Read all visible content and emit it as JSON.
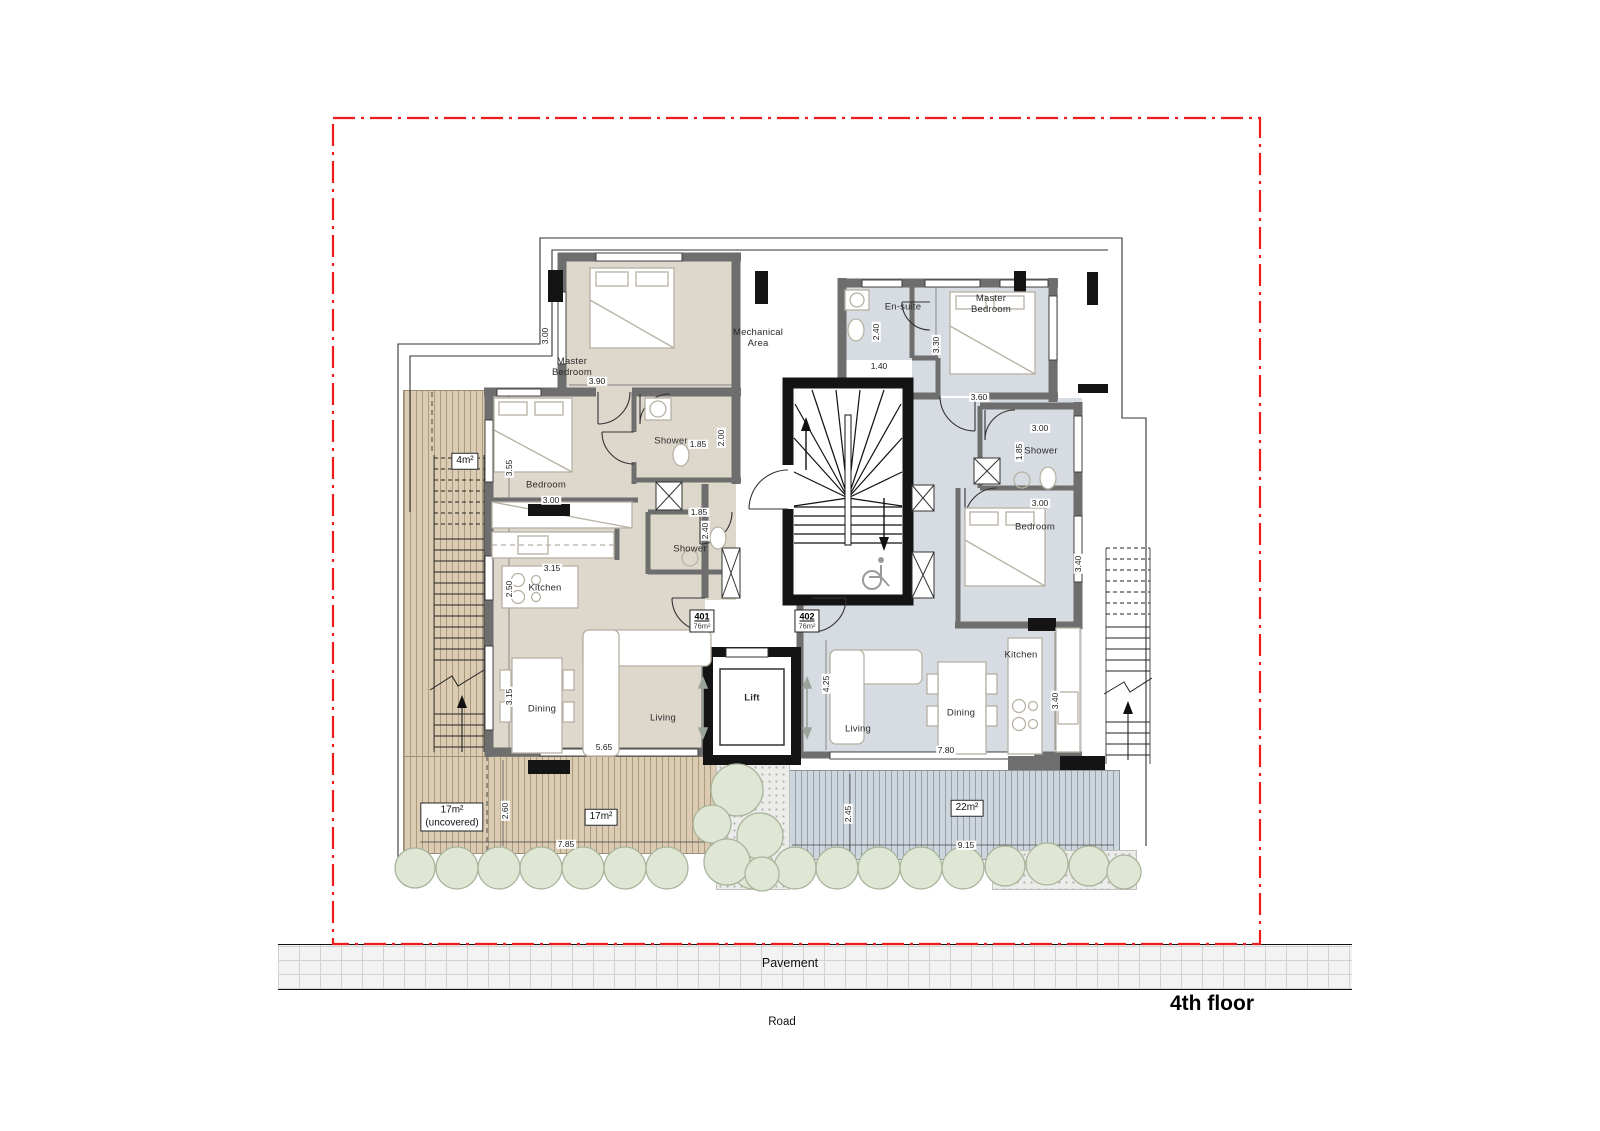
{
  "meta": {
    "title": "4th floor"
  },
  "site": {
    "pavement": "Pavement",
    "road": "Road"
  },
  "core": {
    "lift": "Lift",
    "mechanical": "Mechanical\nArea"
  },
  "apartments": [
    {
      "number": "401",
      "area": "76m²"
    },
    {
      "number": "402",
      "area": "76m²"
    }
  ],
  "colors": {
    "boundary": "#ee1b1b",
    "apartment_401_floor": "#ded8cc",
    "apartment_402_floor": "#d6dce2",
    "deck_wood": "#dacbb2",
    "deck_gray": "#cdd5dd",
    "wall": "#6e6e6e",
    "core_wall": "#141414",
    "tree_fill": "#e0e6d4",
    "tree_stroke": "#a9b49c"
  },
  "labels": {
    "rooms": [
      {
        "text": "Master\nBedroom",
        "x": 572,
        "y": 368
      },
      {
        "text": "Bedroom",
        "x": 546,
        "y": 486
      },
      {
        "text": "Shower",
        "x": 671,
        "y": 442
      },
      {
        "text": "Shower",
        "x": 690,
        "y": 550
      },
      {
        "text": "Kitchen",
        "x": 545,
        "y": 589
      },
      {
        "text": "Dining",
        "x": 542,
        "y": 710
      },
      {
        "text": "Living",
        "x": 663,
        "y": 719
      },
      {
        "text": "En-suite",
        "x": 903,
        "y": 308
      },
      {
        "text": "Master\nBedroom",
        "x": 991,
        "y": 305
      },
      {
        "text": "Shower",
        "x": 1041,
        "y": 452
      },
      {
        "text": "Bedroom",
        "x": 1035,
        "y": 528
      },
      {
        "text": "Kitchen",
        "x": 1021,
        "y": 656
      },
      {
        "text": "Dining",
        "x": 961,
        "y": 714
      },
      {
        "text": "Living",
        "x": 858,
        "y": 730
      }
    ],
    "dims": [
      {
        "t": "3.00",
        "x": 545,
        "y": 336,
        "r": 1
      },
      {
        "t": "3.90",
        "x": 597,
        "y": 381
      },
      {
        "t": "3.55",
        "x": 509,
        "y": 468,
        "r": 1
      },
      {
        "t": "3.00",
        "x": 551,
        "y": 500
      },
      {
        "t": "1.85",
        "x": 698,
        "y": 444
      },
      {
        "t": "2.00",
        "x": 721,
        "y": 438,
        "r": 1
      },
      {
        "t": "1.85",
        "x": 699,
        "y": 512
      },
      {
        "t": "2.40",
        "x": 705,
        "y": 531,
        "r": 1
      },
      {
        "t": "3.15",
        "x": 552,
        "y": 568
      },
      {
        "t": "2.50",
        "x": 509,
        "y": 589,
        "r": 1
      },
      {
        "t": "3.15",
        "x": 509,
        "y": 697,
        "r": 1
      },
      {
        "t": "5.65",
        "x": 604,
        "y": 747
      },
      {
        "t": "2.40",
        "x": 876,
        "y": 332,
        "r": 1
      },
      {
        "t": "1.40",
        "x": 879,
        "y": 366
      },
      {
        "t": "3.30",
        "x": 936,
        "y": 345,
        "r": 1
      },
      {
        "t": "3.60",
        "x": 979,
        "y": 397
      },
      {
        "t": "3.00",
        "x": 1040,
        "y": 428
      },
      {
        "t": "1.85",
        "x": 1019,
        "y": 452,
        "r": 1
      },
      {
        "t": "3.00",
        "x": 1040,
        "y": 503
      },
      {
        "t": "3.40",
        "x": 1078,
        "y": 564,
        "r": 1
      },
      {
        "t": "4.25",
        "x": 826,
        "y": 684,
        "r": 1
      },
      {
        "t": "7.80",
        "x": 946,
        "y": 750
      },
      {
        "t": "3.40",
        "x": 1055,
        "y": 701,
        "r": 1
      },
      {
        "t": "2.60",
        "x": 505,
        "y": 811,
        "r": 1
      },
      {
        "t": "7.85",
        "x": 566,
        "y": 844
      },
      {
        "t": "2.45",
        "x": 848,
        "y": 814,
        "r": 1
      },
      {
        "t": "9.15",
        "x": 966,
        "y": 845
      }
    ],
    "areas": [
      {
        "lines": [
          "4m²"
        ],
        "x": 465,
        "y": 461
      },
      {
        "lines": [
          "17m²",
          "(uncovered)"
        ],
        "x": 452,
        "y": 817
      },
      {
        "lines": [
          "17m²"
        ],
        "x": 601,
        "y": 817
      },
      {
        "lines": [
          "22m²"
        ],
        "x": 967,
        "y": 808
      }
    ]
  }
}
